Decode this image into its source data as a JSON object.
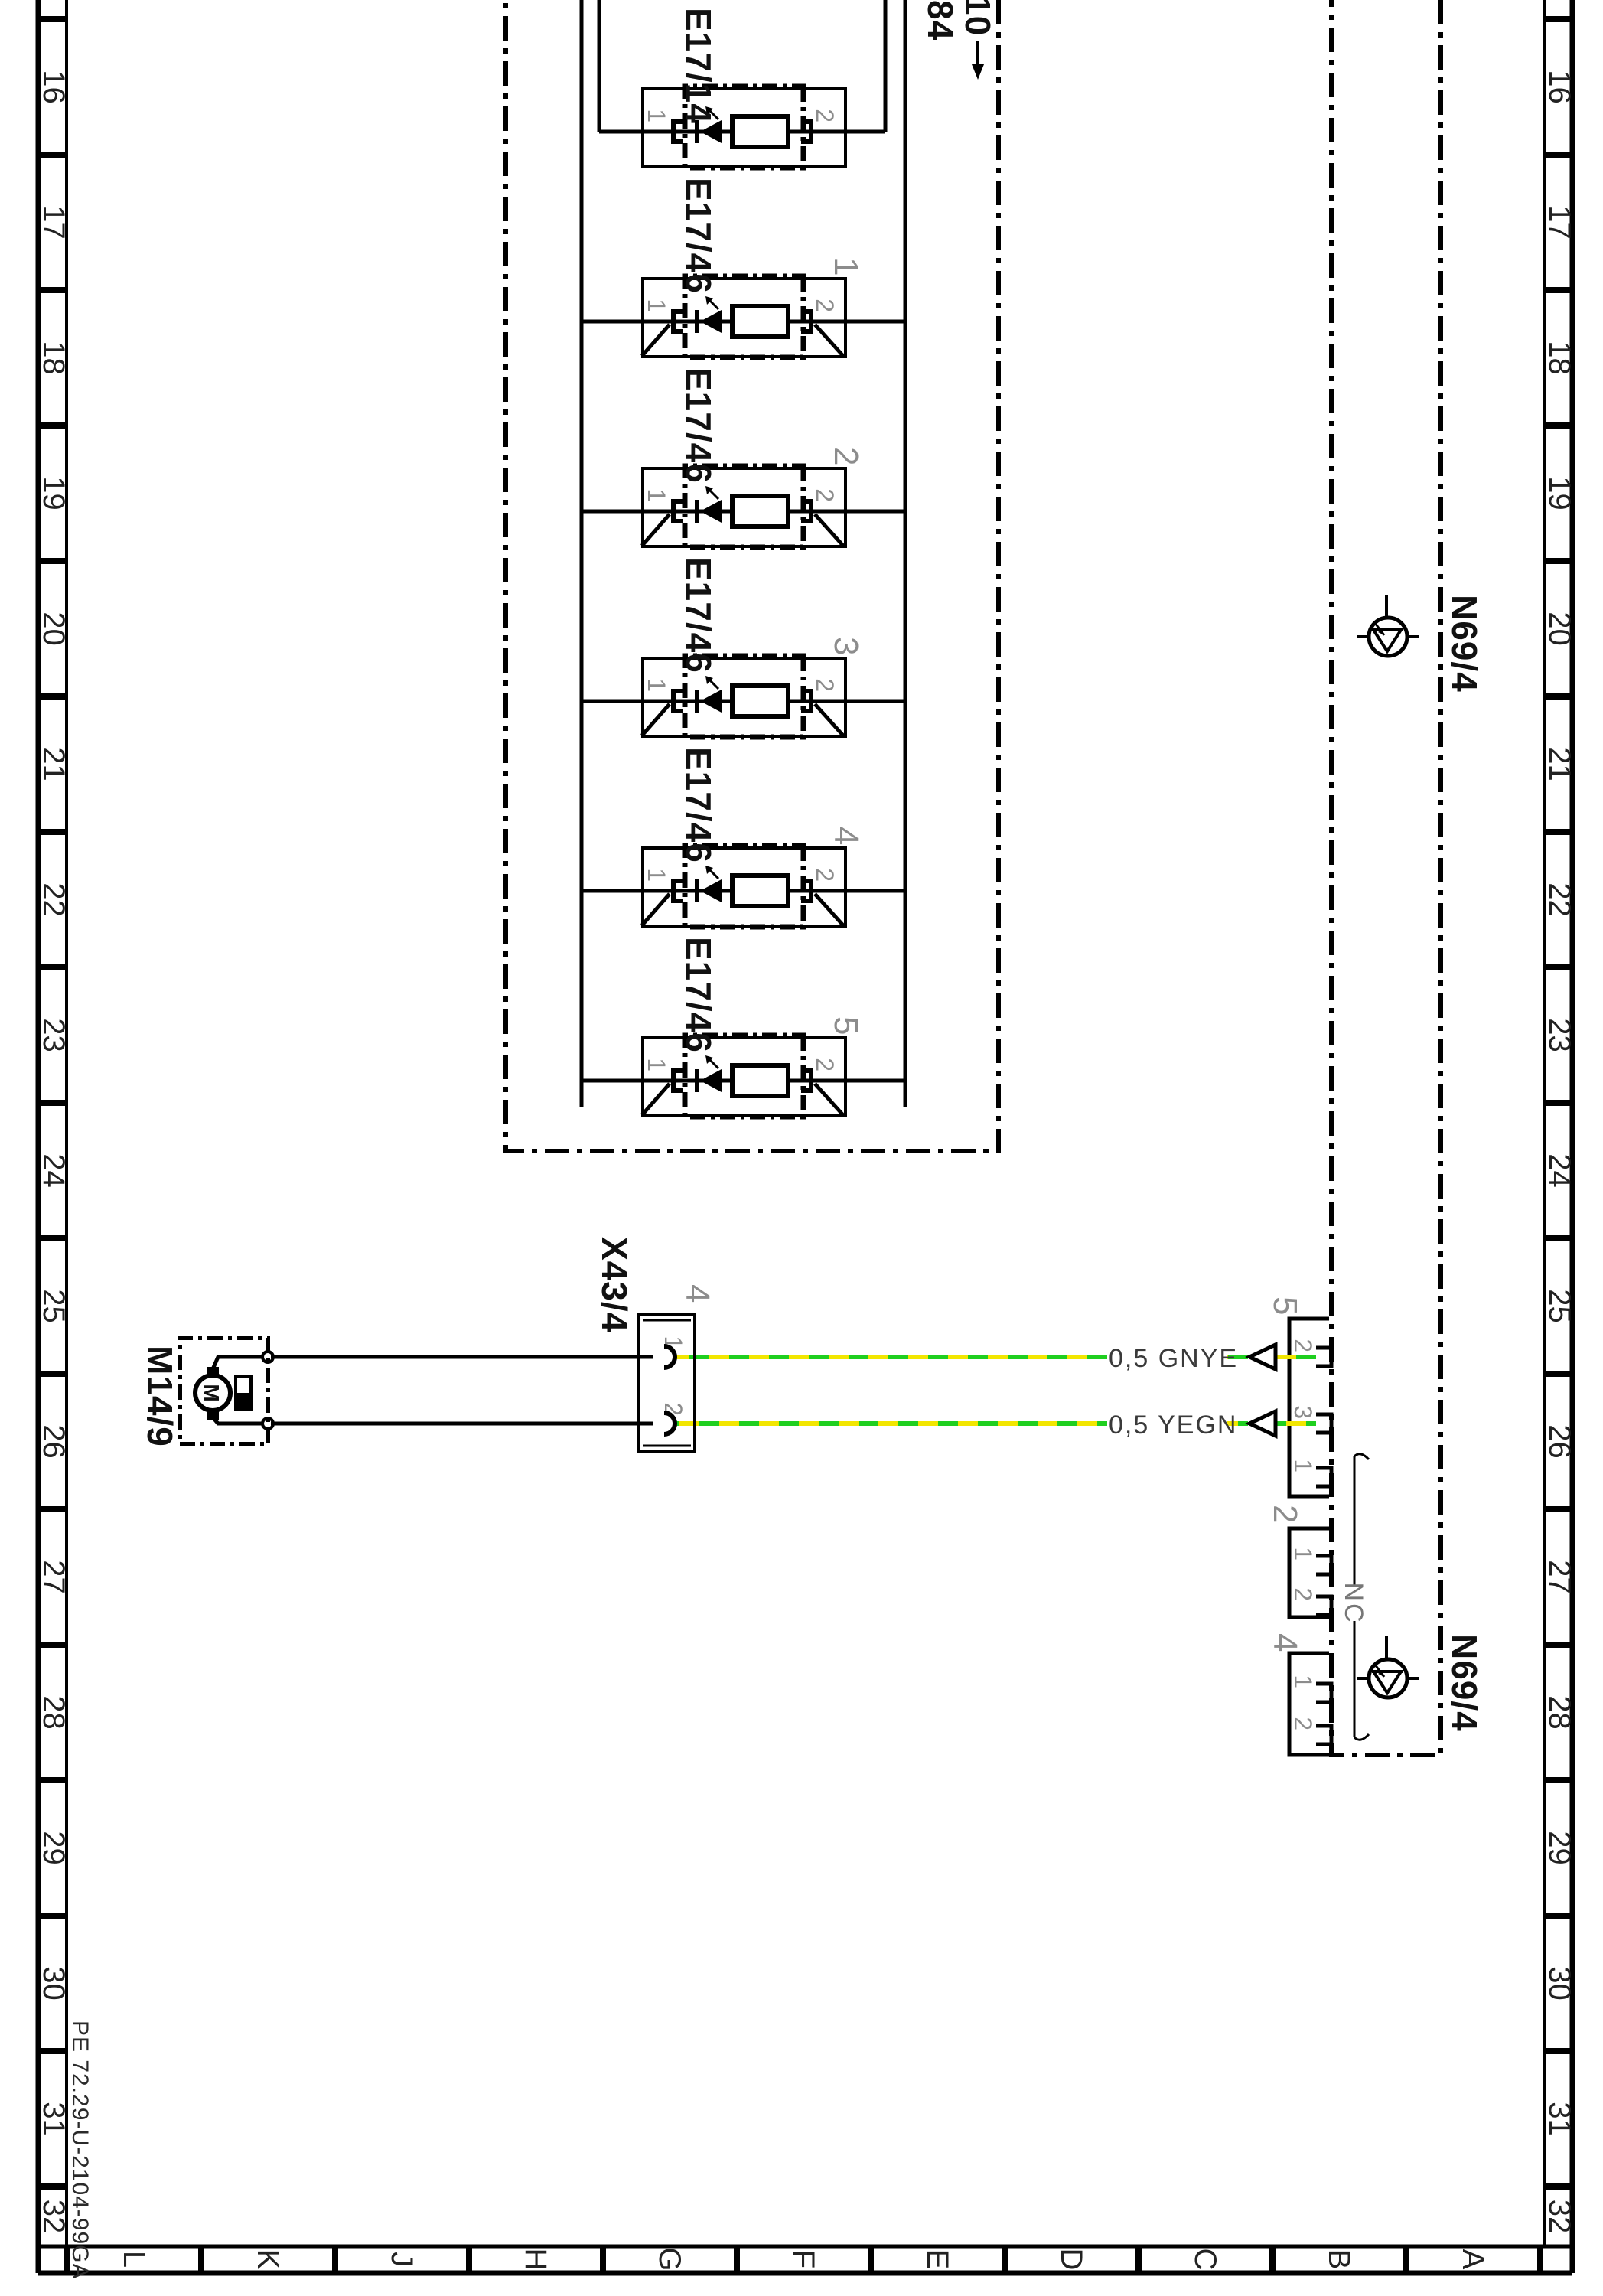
{
  "diagram": {
    "doc_number": "PE 72.29-U-2104-99GA",
    "grid": {
      "columns": [
        "16",
        "17",
        "18",
        "19",
        "20",
        "21",
        "22",
        "23",
        "24",
        "25",
        "26",
        "27",
        "28",
        "29",
        "30",
        "31",
        "32"
      ],
      "rows": [
        "A",
        "B",
        "C",
        "D",
        "E",
        "F",
        "G",
        "H",
        "J",
        "K",
        "L"
      ]
    },
    "lamp_group": {
      "continuation": {
        "fuse_ref": "10",
        "wire_ref": "84"
      },
      "modules": [
        {
          "label": "E17/14",
          "index": "",
          "pin_left": "1",
          "pin_right": "2"
        },
        {
          "label": "E17/46",
          "index": "1",
          "pin_left": "1",
          "pin_right": "2"
        },
        {
          "label": "E17/46",
          "index": "2",
          "pin_left": "1",
          "pin_right": "2"
        },
        {
          "label": "E17/46",
          "index": "3",
          "pin_left": "1",
          "pin_right": "2"
        },
        {
          "label": "E17/46",
          "index": "4",
          "pin_left": "1",
          "pin_right": "2"
        },
        {
          "label": "E17/46",
          "index": "5",
          "pin_left": "1",
          "pin_right": "2"
        }
      ]
    },
    "control_unit": {
      "label_left": "N69/4",
      "label_right": "N69/4",
      "nc_label": "NC",
      "connectors": [
        {
          "index": "5",
          "pins": [
            "2",
            "3",
            "1"
          ]
        },
        {
          "index": "2",
          "pins": [
            "1",
            "2"
          ]
        },
        {
          "index": "4",
          "pins": [
            "1",
            "2"
          ]
        }
      ]
    },
    "connector": {
      "label": "X43/4",
      "index": "4",
      "pins": [
        "1",
        "2"
      ]
    },
    "pump": {
      "label": "M14/9",
      "symbol": "M"
    },
    "wires": [
      {
        "label": "0,5 GNYE"
      },
      {
        "label": "0,5 YEGN"
      }
    ],
    "colors": {
      "green": "#1fcf1f",
      "yellow": "#f2e600",
      "gray": "#8c8c8c",
      "line": "#000000"
    }
  }
}
